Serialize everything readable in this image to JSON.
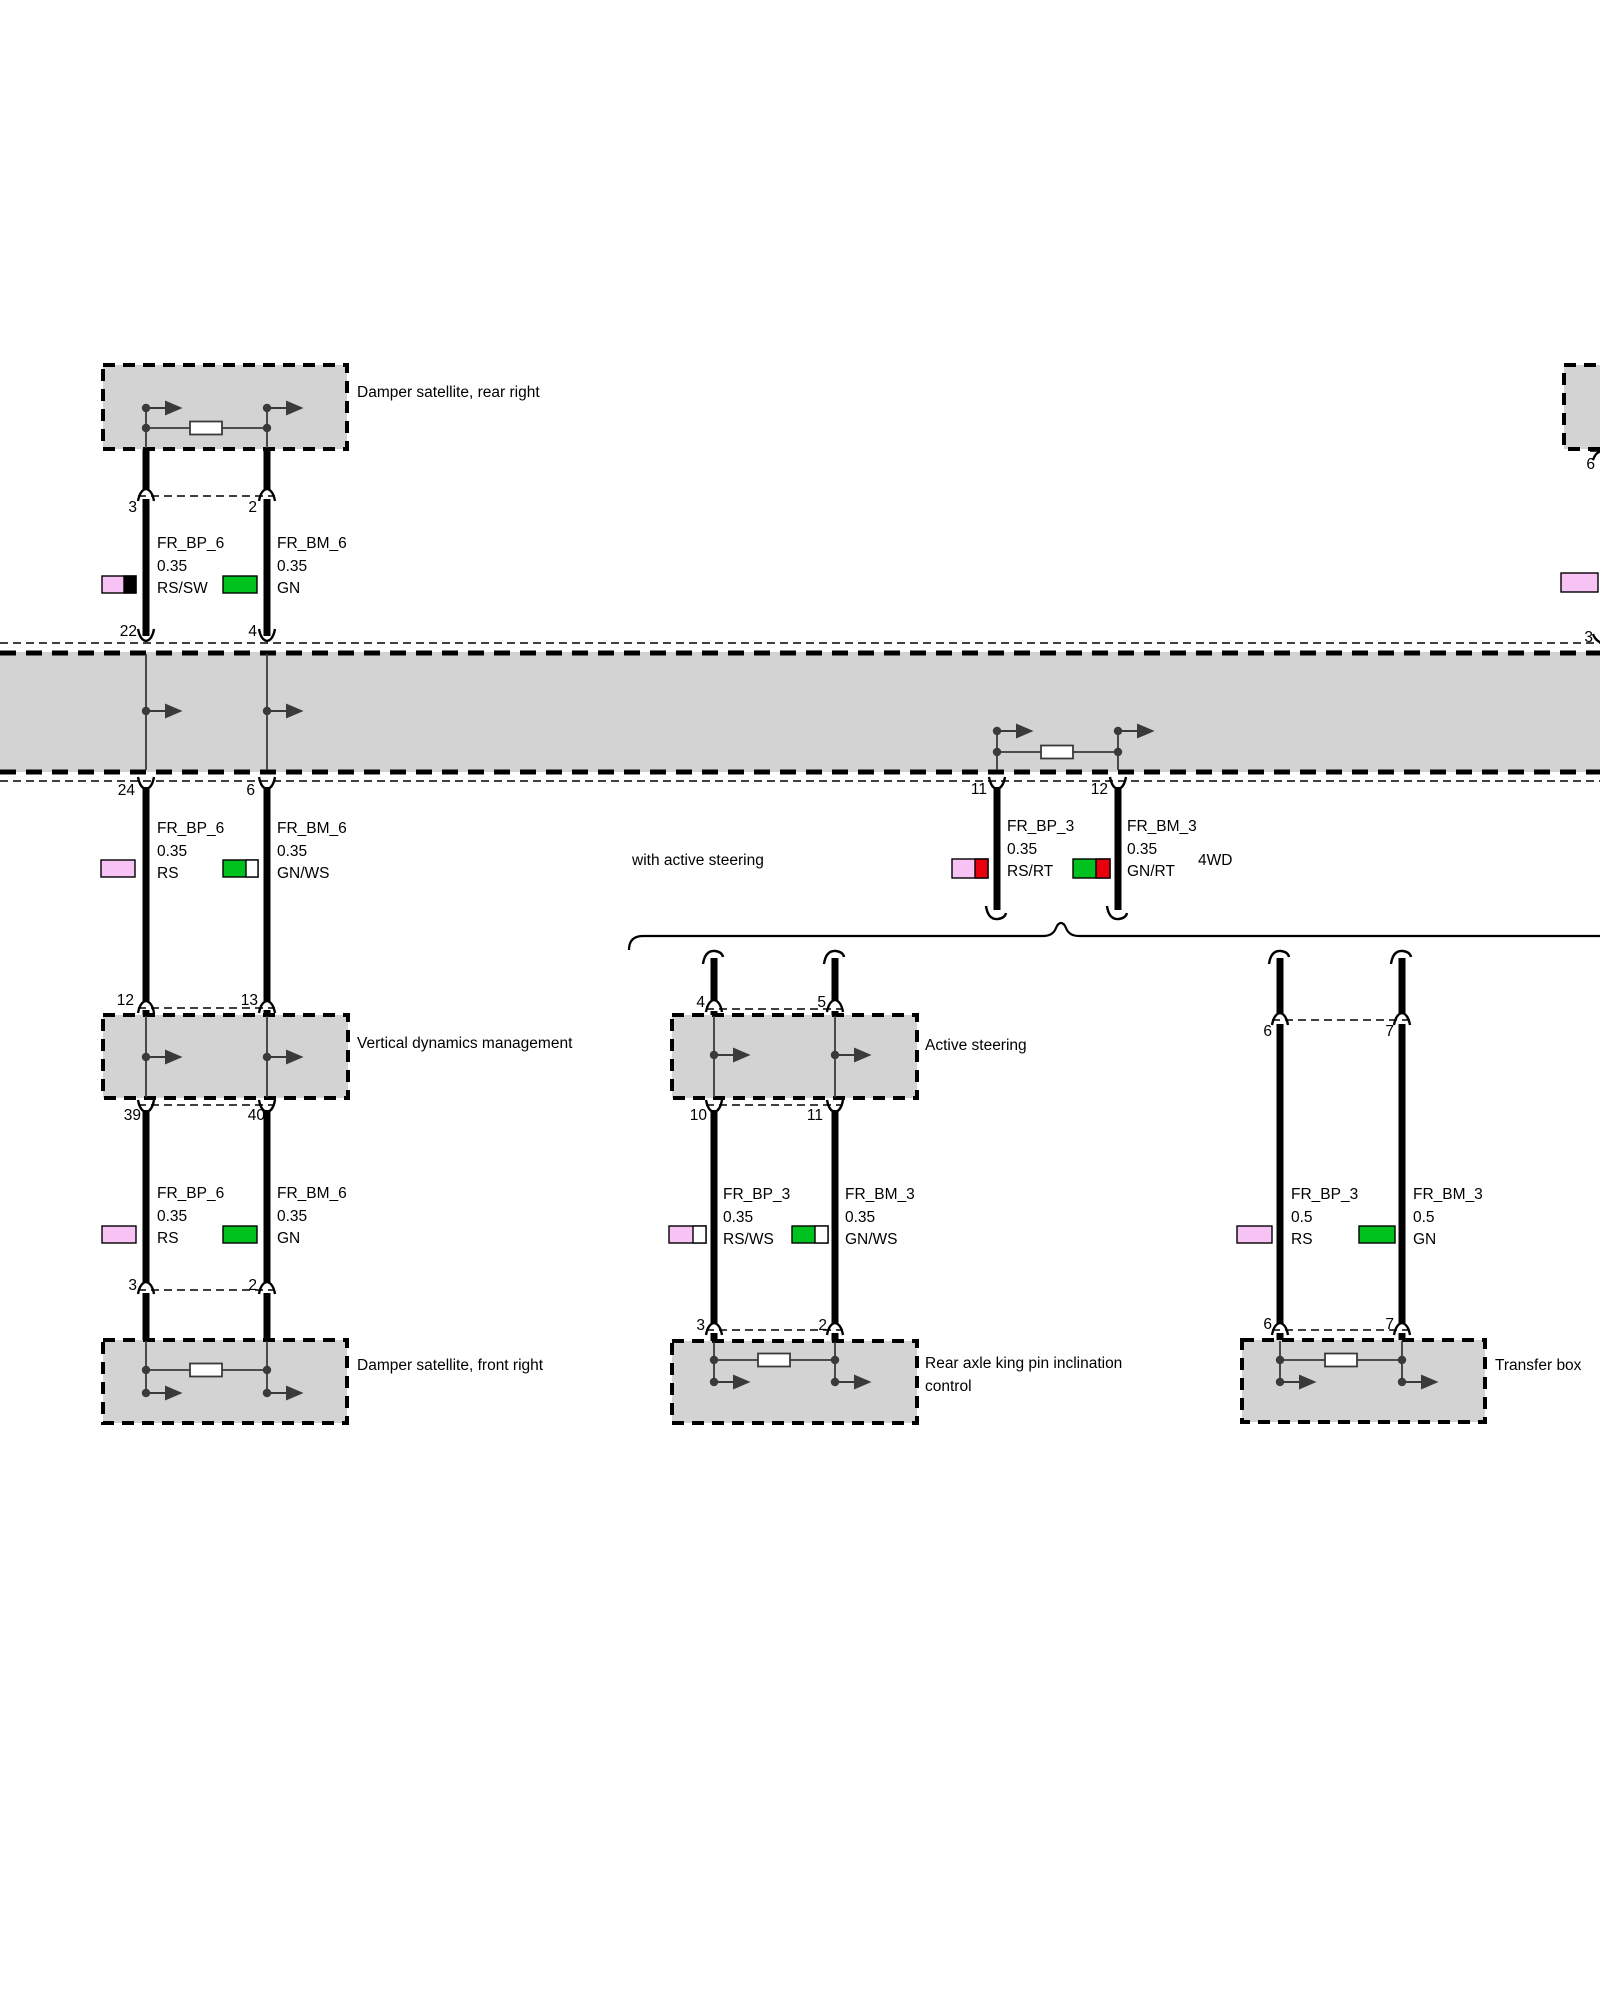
{
  "diagram": {
    "boxes": {
      "damper_rear": "Damper satellite, rear right",
      "vertical_dynamics": "Vertical dynamics management",
      "damper_front": "Damper satellite, front right",
      "active_steering": "Active steering",
      "rear_axle": "Rear axle king pin inclination control",
      "transfer_box": "Transfer box"
    },
    "notes": {
      "with_active_steering": "with active steering",
      "four_wd": "4WD"
    },
    "wires": {
      "seg1_left": {
        "name": "FR_BP_6",
        "size": "0.35",
        "color": "RS/SW"
      },
      "seg1_right": {
        "name": "FR_BM_6",
        "size": "0.35",
        "color": "GN"
      },
      "seg2_left": {
        "name": "FR_BP_6",
        "size": "0.35",
        "color": "RS"
      },
      "seg2_right": {
        "name": "FR_BM_6",
        "size": "0.35",
        "color": "GN/WS"
      },
      "seg3_left": {
        "name": "FR_BP_6",
        "size": "0.35",
        "color": "RS"
      },
      "seg3_right": {
        "name": "FR_BM_6",
        "size": "0.35",
        "color": "GN"
      },
      "mid_left": {
        "name": "FR_BP_3",
        "size": "0.35",
        "color": "RS/RT"
      },
      "mid_right": {
        "name": "FR_BM_3",
        "size": "0.35",
        "color": "GN/RT"
      },
      "as_left": {
        "name": "FR_BP_3",
        "size": "0.35",
        "color": "RS/WS"
      },
      "as_right": {
        "name": "FR_BM_3",
        "size": "0.35",
        "color": "GN/WS"
      },
      "tb_left": {
        "name": "FR_BP_3",
        "size": "0.5",
        "color": "RS"
      },
      "tb_right": {
        "name": "FR_BM_3",
        "size": "0.5",
        "color": "GN"
      }
    },
    "pins": {
      "seg1_top_left": "3",
      "seg1_top_right": "2",
      "seg1_bottom_left": "22",
      "seg1_bottom_right": "4",
      "seg2_top_left": "24",
      "seg2_top_right": "6",
      "seg2_bottom_left": "12",
      "seg2_bottom_right": "13",
      "seg3_top_left": "39",
      "seg3_top_right": "40",
      "seg3_bottom_left": "3",
      "seg3_bottom_right": "2",
      "mid_left": "11",
      "mid_right": "12",
      "as_top_left": "4",
      "as_top_right": "5",
      "as_mid_left": "10",
      "as_mid_right": "11",
      "as_bottom_left": "3",
      "as_bottom_right": "2",
      "tb_top_left": "6",
      "tb_top_right": "7",
      "tb_bottom_left": "6",
      "tb_bottom_right": "7",
      "edge_top": "6",
      "edge_bottom": "3"
    },
    "colors": {
      "box_gray": "#d3d3d3",
      "pink": "#f7c2f4",
      "green": "#00c21f",
      "red": "#e8000d",
      "black": "#000000",
      "white": "#ffffff"
    }
  }
}
